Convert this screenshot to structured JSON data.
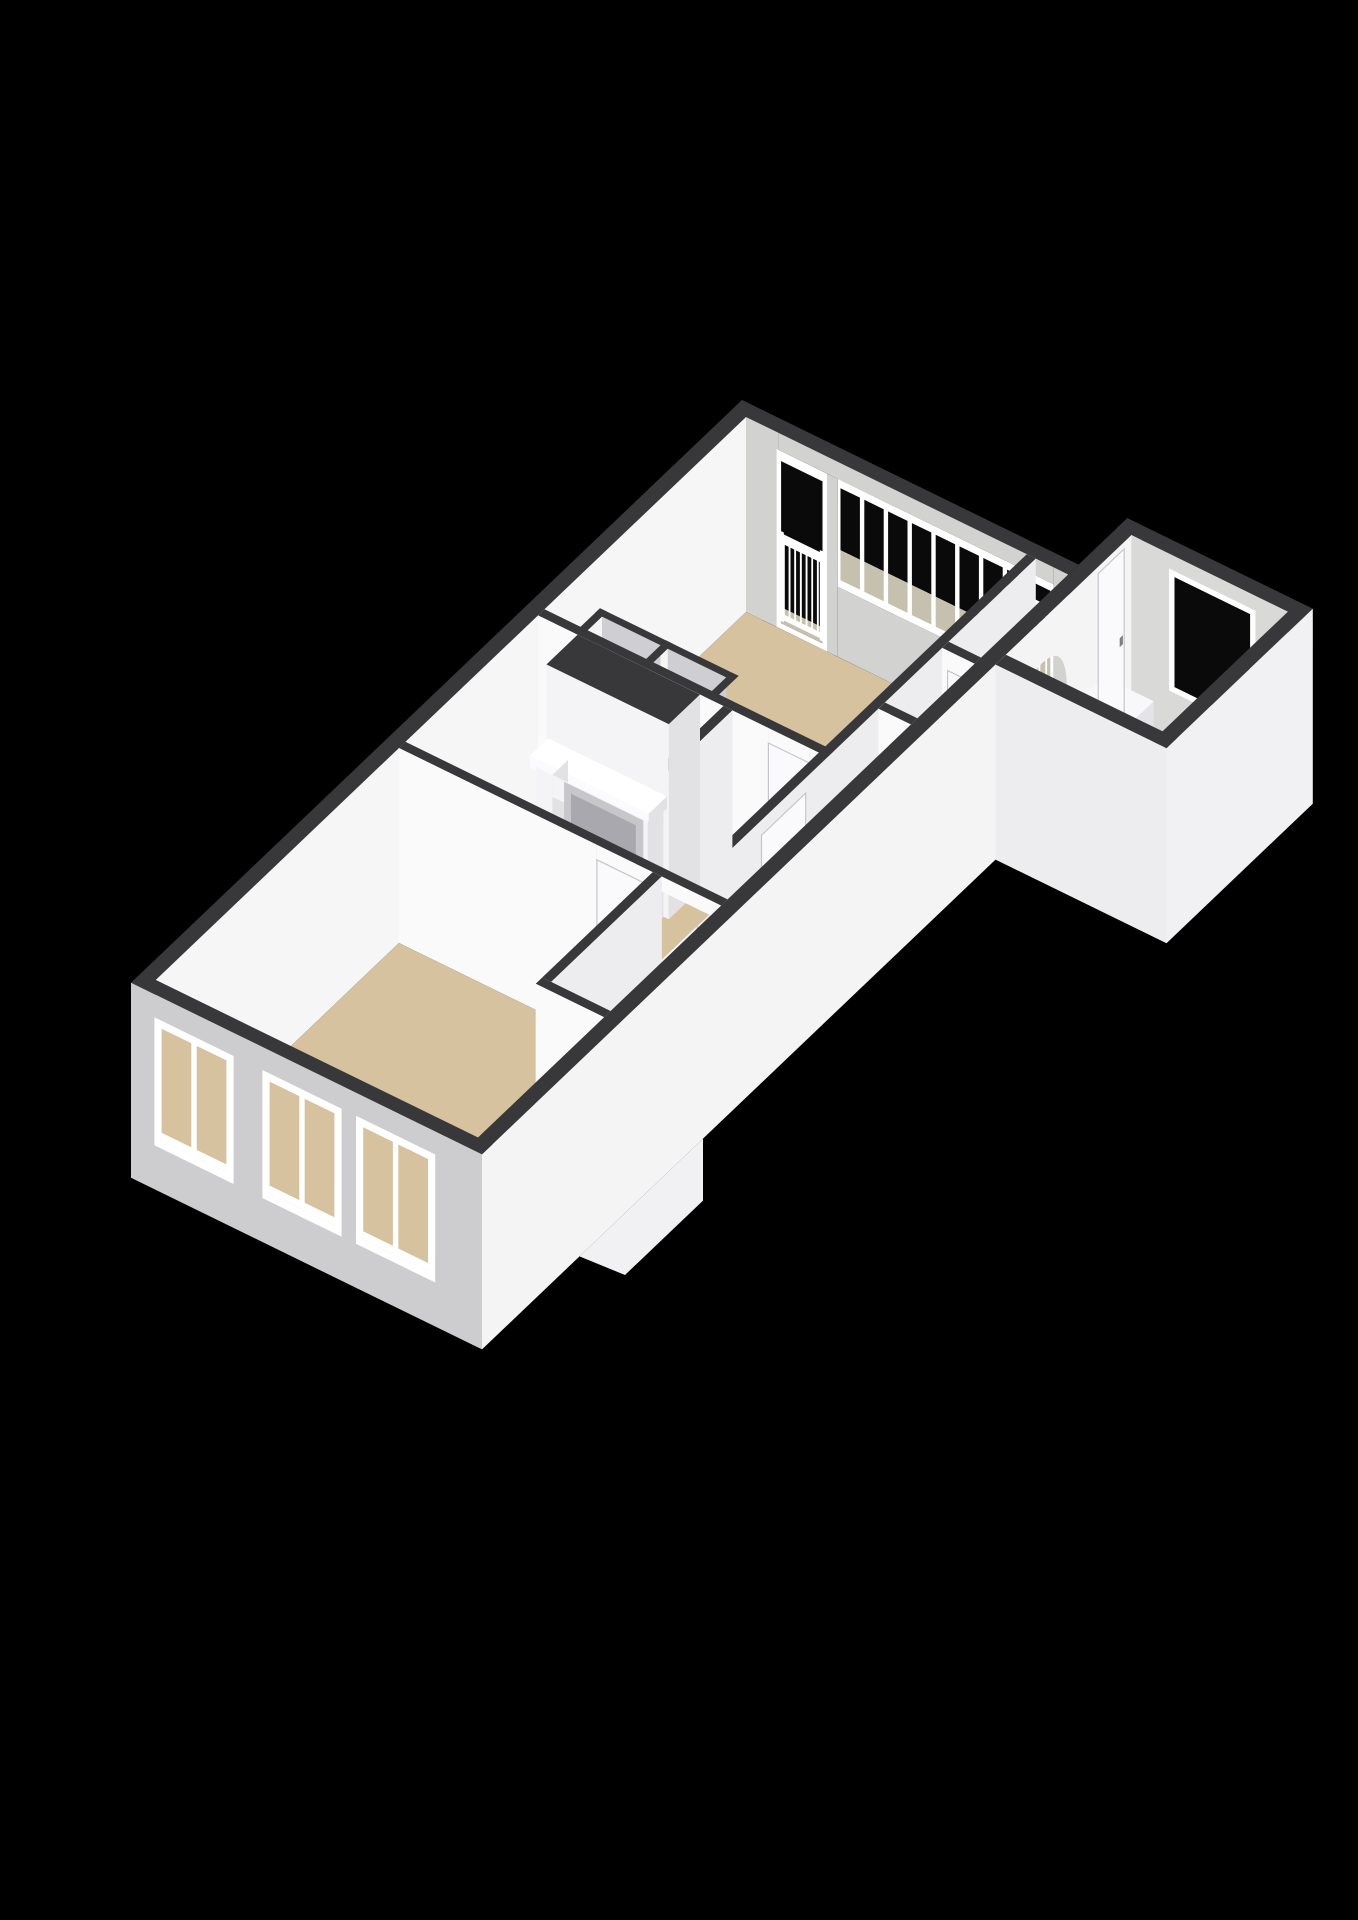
{
  "scene": {
    "type": "3d-floorplan-render",
    "background": "#000000",
    "view": "isometric-top-down",
    "text_content": "none"
  },
  "palette": {
    "background": "#000000",
    "wallTop": "#38383A",
    "wallTopDark": "#2E2E30",
    "innerBright": "#F6F6F7",
    "neWallFace": "#D2D2D0",
    "uWallFace": "#FAFAFB",
    "vWallFace": "#EDEDEF",
    "wallSide": "#E2E2E5",
    "exteriorSW": "#CDCDD0",
    "exteriorSE": "#F4F4F5",
    "blockNEFace": "#D9D9D8",
    "blockSEOuter": "#F1F1F3",
    "blockSWOuter": "#EDEDEF",
    "floorWood": "#D7C2A0",
    "floorBath": "#C9D2DD",
    "floorStairs": "#DCA75F",
    "floorStoreroom": "#D5D5D7",
    "cellFloor": "#6E6E74",
    "cellWall": "#CFCFD3",
    "balconyFloor": "#C5C1AE",
    "glass": "#0A0A0B",
    "frameWhite": "#FFFFFF",
    "doorLeaf": "#FAFAFC",
    "doorSeam": "#C6C6CA",
    "handle": "#7F7F84",
    "mantelFront": "#F4F4F6",
    "mantelBright": "#FBFBFD",
    "mantelSide": "#E2E2E5",
    "fireboxBack": "#C7C7CB",
    "fireboxInner": "#A8A8AE",
    "hearth": "#E9E9EB",
    "counterTop": "#F8F8FA",
    "counterFront": "#EFEFF2",
    "counterSide": "#E4E4E8",
    "stepTop": "#EFEFF1",
    "stepFront": "#DFDFE3",
    "porch": "#F1F1F3"
  },
  "rooms": [
    {
      "id": "living-room",
      "floor": "wood"
    },
    {
      "id": "sitting-room-fireplace",
      "floor": "wood"
    },
    {
      "id": "bedroom",
      "floor": "wood"
    },
    {
      "id": "hall",
      "floor": "wood"
    },
    {
      "id": "corridor-landing",
      "floor": "wood"
    },
    {
      "id": "wc",
      "floor": "wood"
    },
    {
      "id": "bathroom",
      "floor": "tile-blue"
    },
    {
      "id": "stairwell",
      "floor": "stairs-amber"
    },
    {
      "id": "closet-left",
      "floor": "dark"
    },
    {
      "id": "closet-right",
      "floor": "dark"
    },
    {
      "id": "storeroom",
      "floor": "gray"
    }
  ],
  "features": [
    "french-balcony-railing",
    "balcony-window-strip",
    "balcony-door",
    "chimney-breast",
    "fireplace-mantel",
    "hearth",
    "archway",
    "bathroom-window",
    "bathroom-door",
    "bathroom-cabinet",
    "corridor-door",
    "hall-door",
    "bedroom-door",
    "wc-door",
    "stair-step",
    "porch-notch",
    "facade-window-1",
    "facade-window-2",
    "facade-window-3"
  ]
}
